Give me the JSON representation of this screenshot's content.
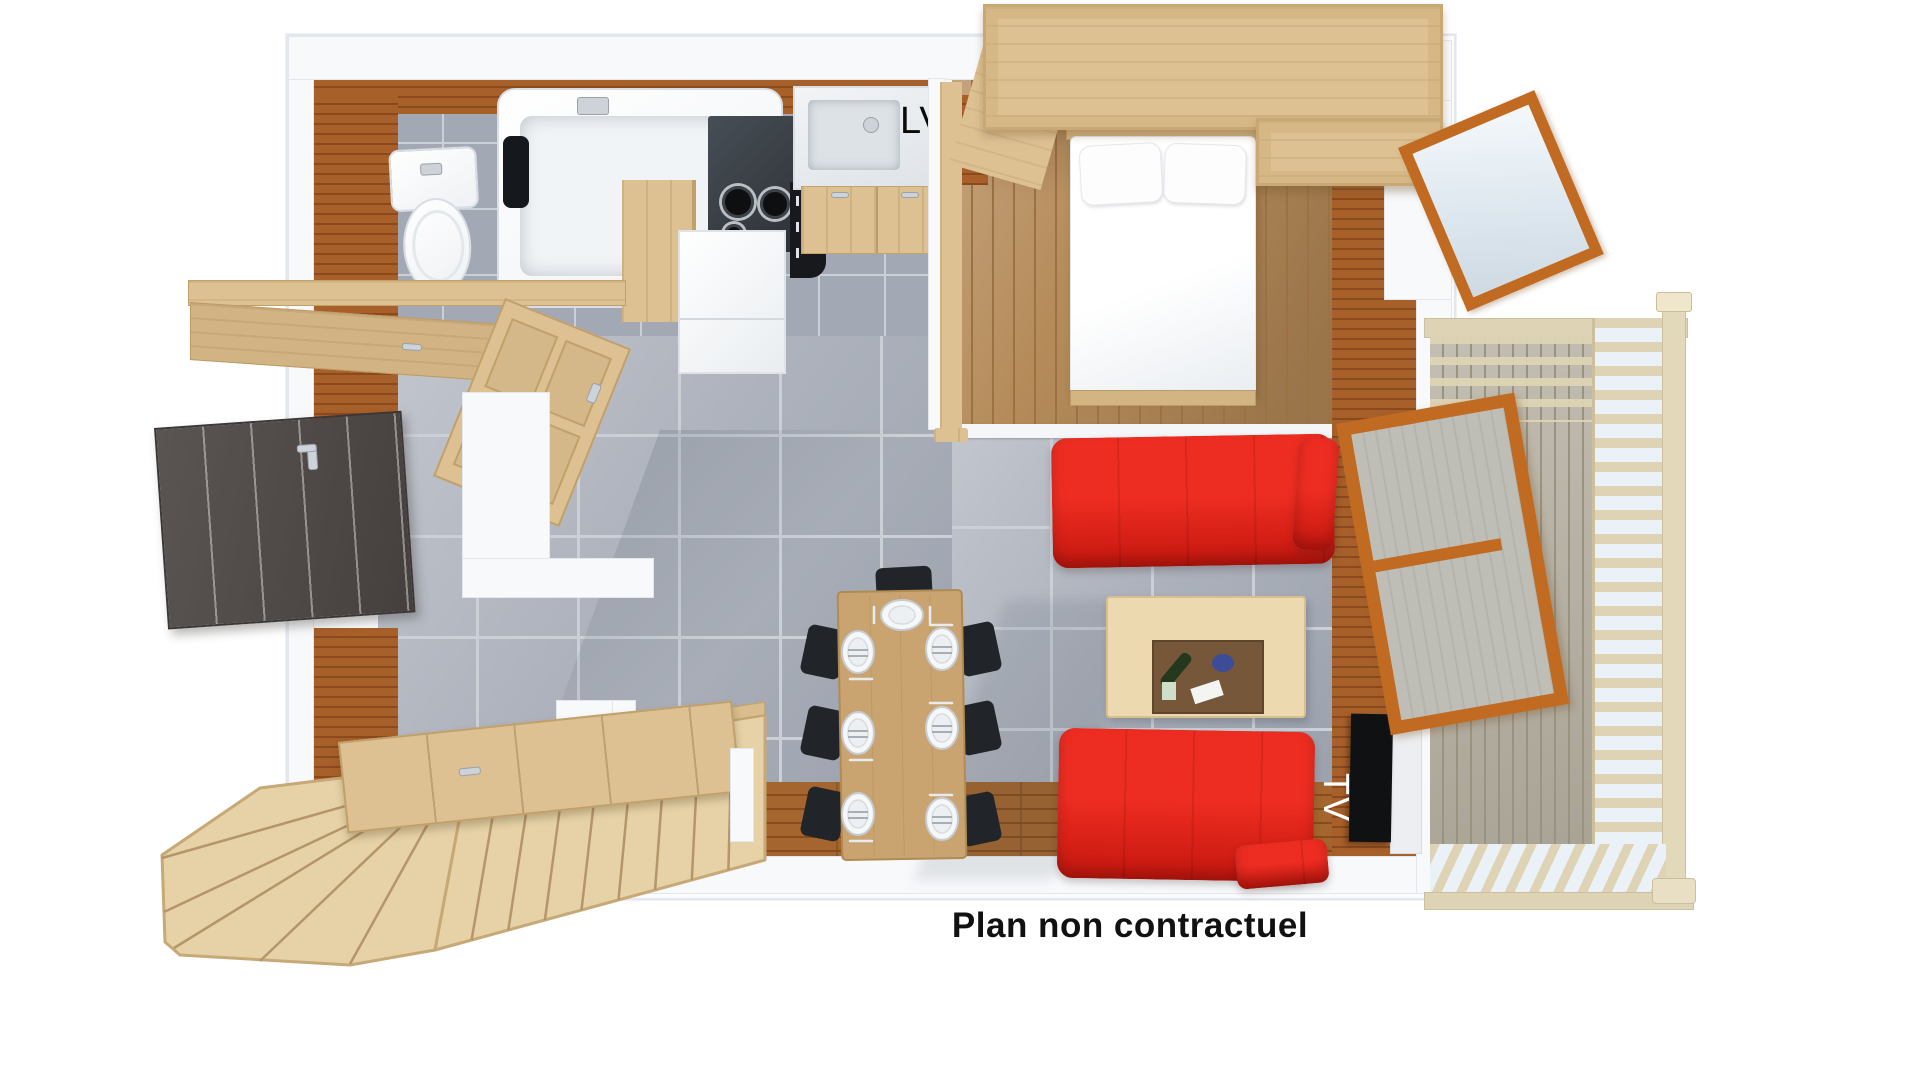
{
  "caption": "Plan non contractuel",
  "labels": {
    "dishwasher": "LV",
    "tv": "TV"
  },
  "colors": {
    "page-bg": "#ffffff",
    "wall-white": "#f7f9fb",
    "wall-edge": "#e2e8ee",
    "wood-wall": "#a8602a",
    "wood-wall-dark": "#8a4a1e",
    "wood-light": "#ddc193",
    "wood-light-dark": "#c7a571",
    "stair-wood": "#e6d2a6",
    "stair-line": "#b5956a",
    "floor-bedroom": "#b58b5a",
    "floor-bedroom-dark": "#9c7243",
    "floor-warm": "#a4662e",
    "floor-warm-dark": "#884c1e",
    "tile": "#aeb3bd",
    "tile-bath": "#a2a8b4",
    "tile-grout": "#cbd0d7",
    "deck": "#b7b1a2",
    "deck-dark": "#999381",
    "slat": "#ded3b4",
    "sky": "#eaf1f7",
    "sofa-red": "#ee2d22",
    "sofa-red-dark": "#c5170e",
    "counter-dark": "#3a4046",
    "appliance-black": "#17191c",
    "chair-black": "#212529",
    "door-dark": "#4e4846",
    "frame-orange": "#c06a22",
    "fixture-edge": "#d8dee4",
    "tv-black": "#0f1113",
    "label-black": "#0a0a0a",
    "label-white": "#ffffff",
    "caption-text": "#111111"
  }
}
